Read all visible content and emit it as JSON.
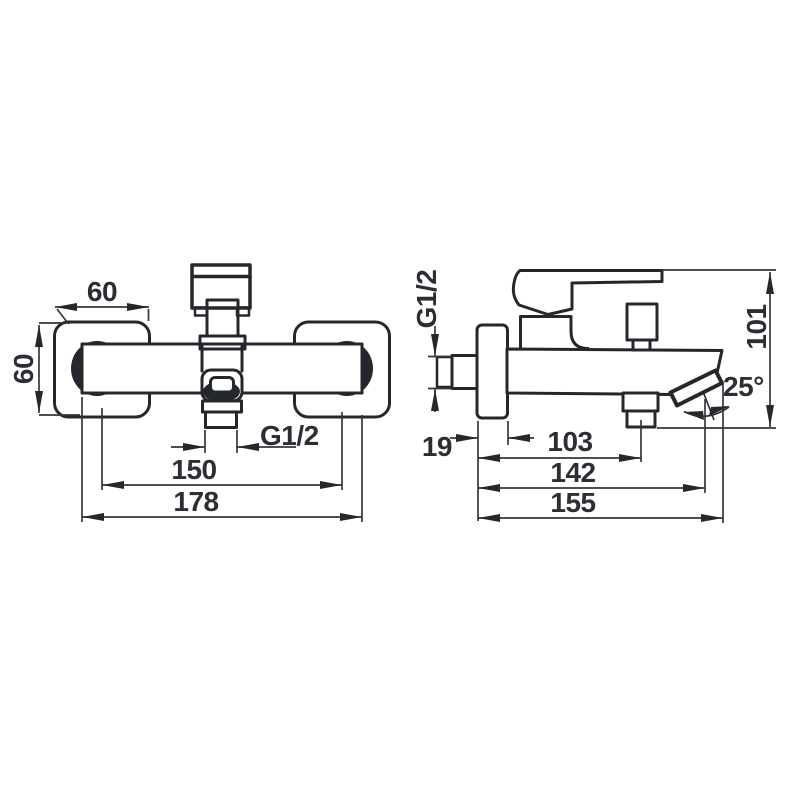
{
  "drawing": {
    "background": "#ffffff",
    "line_color": "#24282c",
    "dim_color": "#2b2f33",
    "front_view": {
      "plate_width": "60",
      "plate_height": "60",
      "shower_outlet_thread": "G1/2",
      "connection_centers": "150",
      "overall_width": "178"
    },
    "side_view": {
      "wall_connection_thread": "G1/2",
      "flange_depth": "19",
      "outlet_distance": "103",
      "aerator_distance": "142",
      "spout_length": "155",
      "overall_height": "101",
      "spout_angle": "25°"
    }
  }
}
